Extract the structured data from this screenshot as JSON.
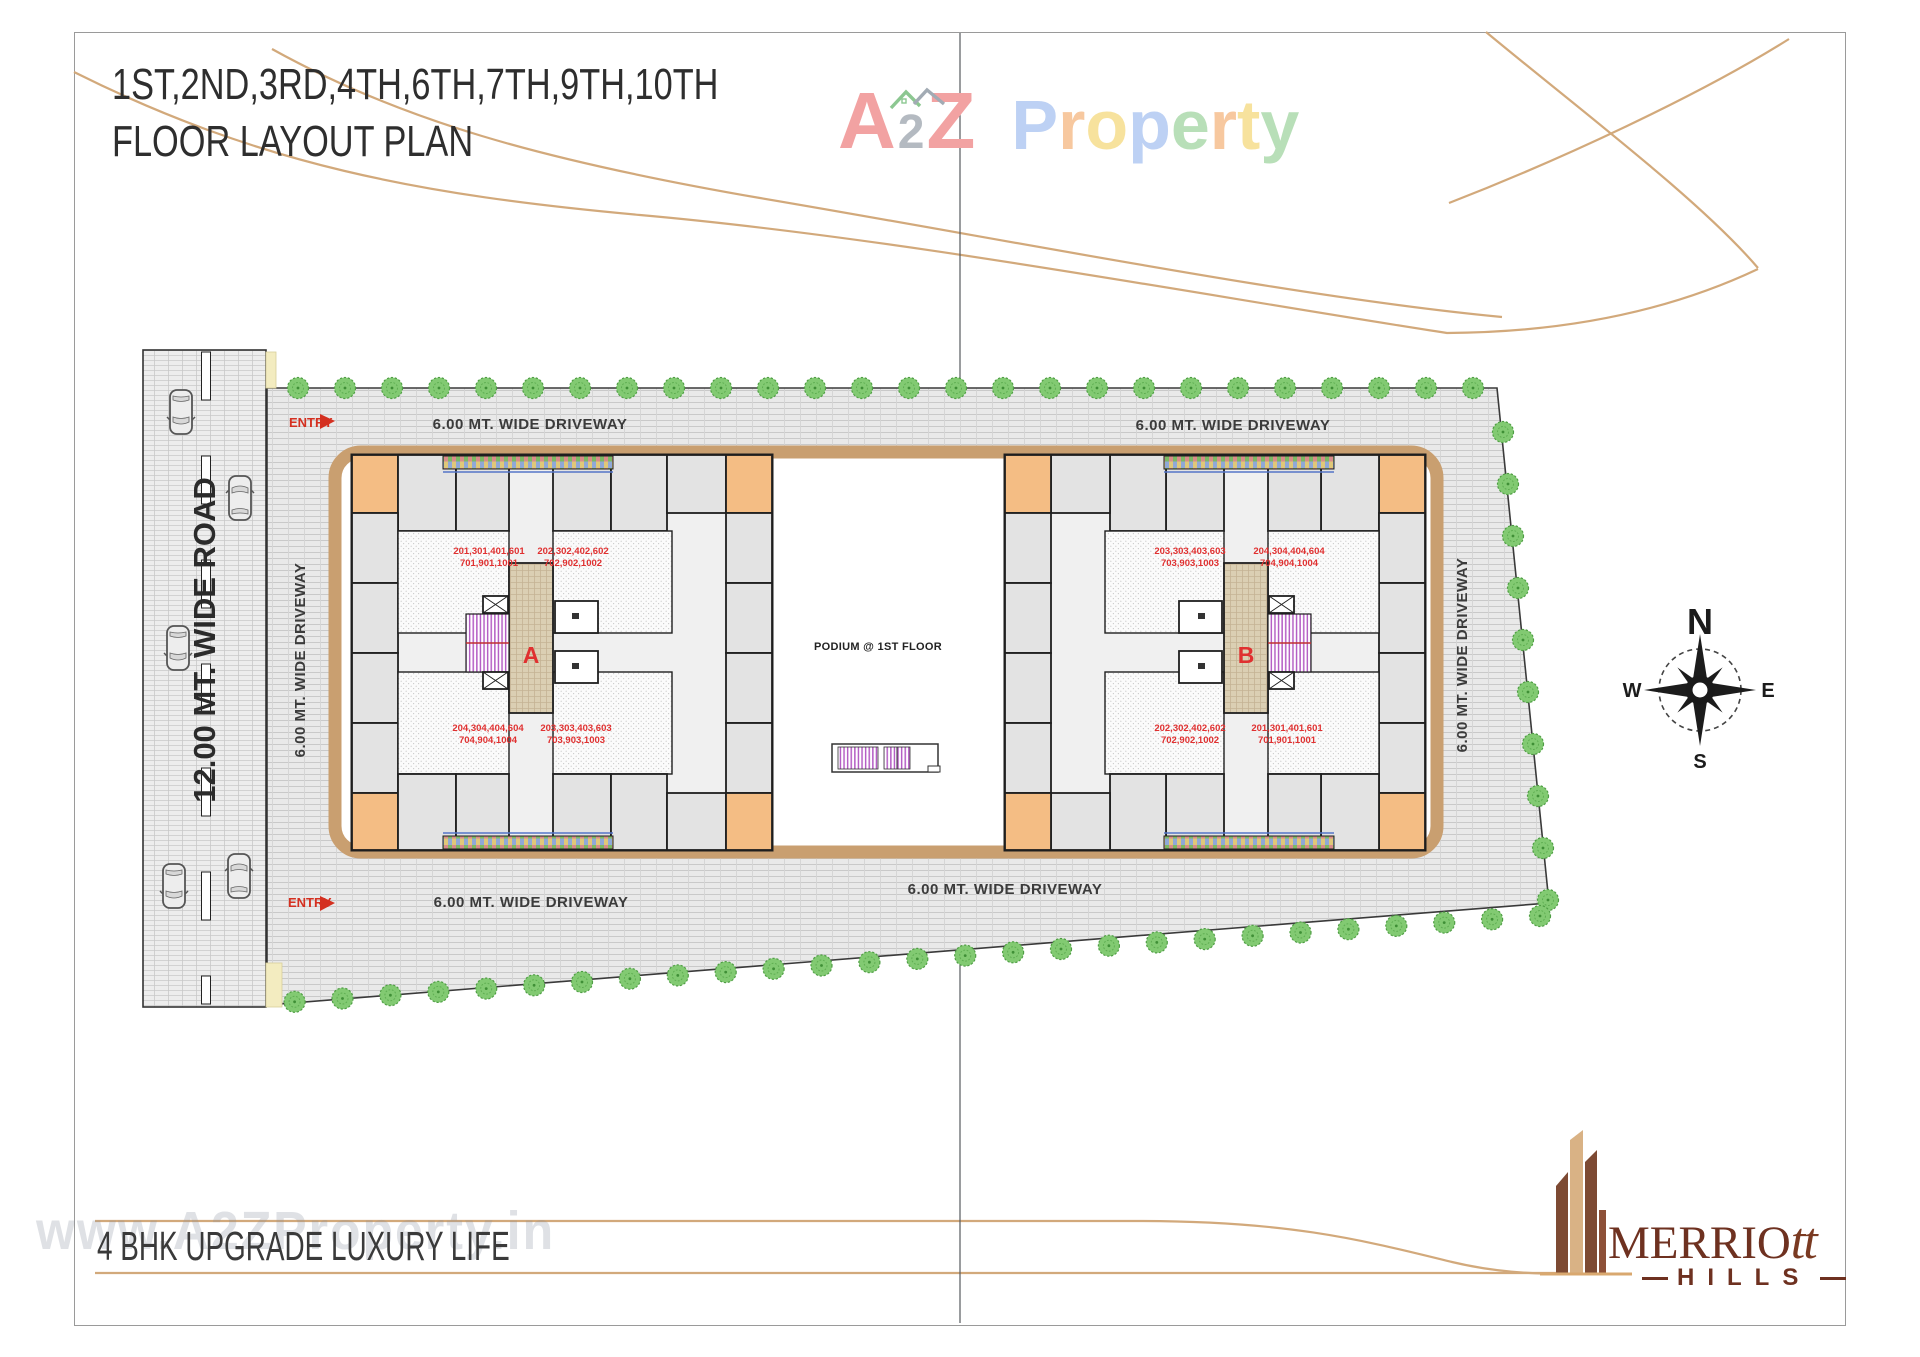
{
  "header": {
    "title_line1": "1ST,2ND,3RD,4TH,6TH,7TH,9TH,10TH",
    "title_line2": "FLOOR LAYOUT PLAN"
  },
  "brand": {
    "a2z_a": "A",
    "a2z_2": "2",
    "a2z_z": "Z",
    "property_letters": [
      "P",
      "r",
      "o",
      "p",
      "e",
      "r",
      "t",
      "y"
    ]
  },
  "plan": {
    "road_label": "12.00 MT. WIDE ROAD",
    "driveway_label": "6.00 MT. WIDE DRIVEWAY",
    "entry_label": "ENTRY",
    "podium_label": "PODIUM @ 1ST FLOOR",
    "compass": {
      "north": "N",
      "south": "S",
      "east": "E",
      "west": "W"
    },
    "towers": [
      {
        "name": "A",
        "units": {
          "top_left": [
            "201,301,401,601",
            "701,901,1001"
          ],
          "top_right": [
            "202,302,402,602",
            "702,902,1002"
          ],
          "bottom_left": [
            "204,304,404,604",
            "704,904,1004"
          ],
          "bottom_right": [
            "203,303,403,603",
            "703,903,1003"
          ]
        }
      },
      {
        "name": "B",
        "units": {
          "top_left": [
            "203,303,403,603",
            "703,903,1003"
          ],
          "top_right": [
            "204,304,404,604",
            "704,904,1004"
          ],
          "bottom_left": [
            "202,302,402,602",
            "702,902,1002"
          ],
          "bottom_right": [
            "201,301,401,601",
            "701,901,1001"
          ]
        }
      }
    ]
  },
  "footer": {
    "tagline": "4 BHK UPGRADE LUXURY LIFE",
    "watermark": "www.A2ZProperty.in",
    "developer_main": "MERRIO",
    "developer_tail": "tt",
    "developer_sub": "HILLS"
  },
  "colors": {
    "accent_tan": "#d2a97b",
    "entry_red": "#d43020",
    "unit_red": "#e03030",
    "brand_maroon": "#6e3120",
    "tree_green": "#82ca72"
  }
}
